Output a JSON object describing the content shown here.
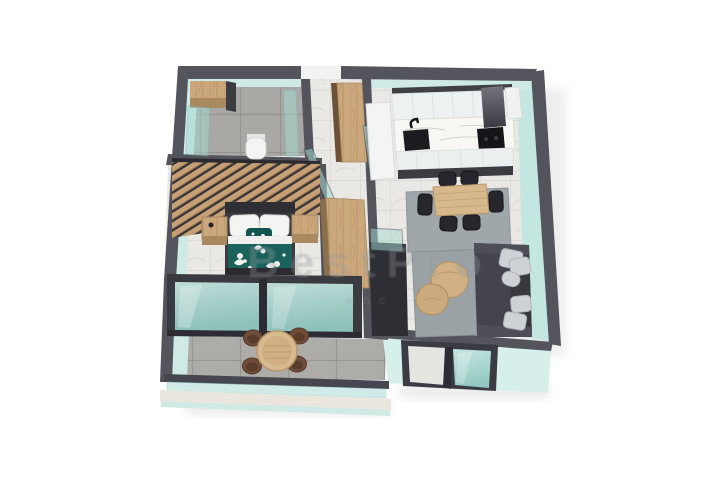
{
  "scene": {
    "description": "3D isometric render of a one-bedroom apartment floor plan",
    "rooms": {
      "bathroom": "Bathroom",
      "hallway": "Hallway",
      "kitchen": "Kitchen",
      "dining": "Dining area",
      "living": "Living room",
      "bedroom": "Bedroom",
      "balcony": "Balcony"
    }
  },
  "watermark": {
    "line1": "BestPro",
    "line2": "мос"
  },
  "palette": {
    "background": "#ffffff",
    "wall_top": "#54545c",
    "wall_dark": "#2e2e35",
    "wall_mint": "#cdeae6",
    "glass_teal": "#a5dad2",
    "floor_marble": "#eae8e4",
    "floor_concrete": "#a7a6a3",
    "wood": "#cba77c",
    "sofa_gray": "#44444c",
    "rug_gray": "#9da4a8",
    "duvet_teal": "#1a625b",
    "chair_black": "#26262c",
    "chair_brown": "#6f4d3a"
  }
}
